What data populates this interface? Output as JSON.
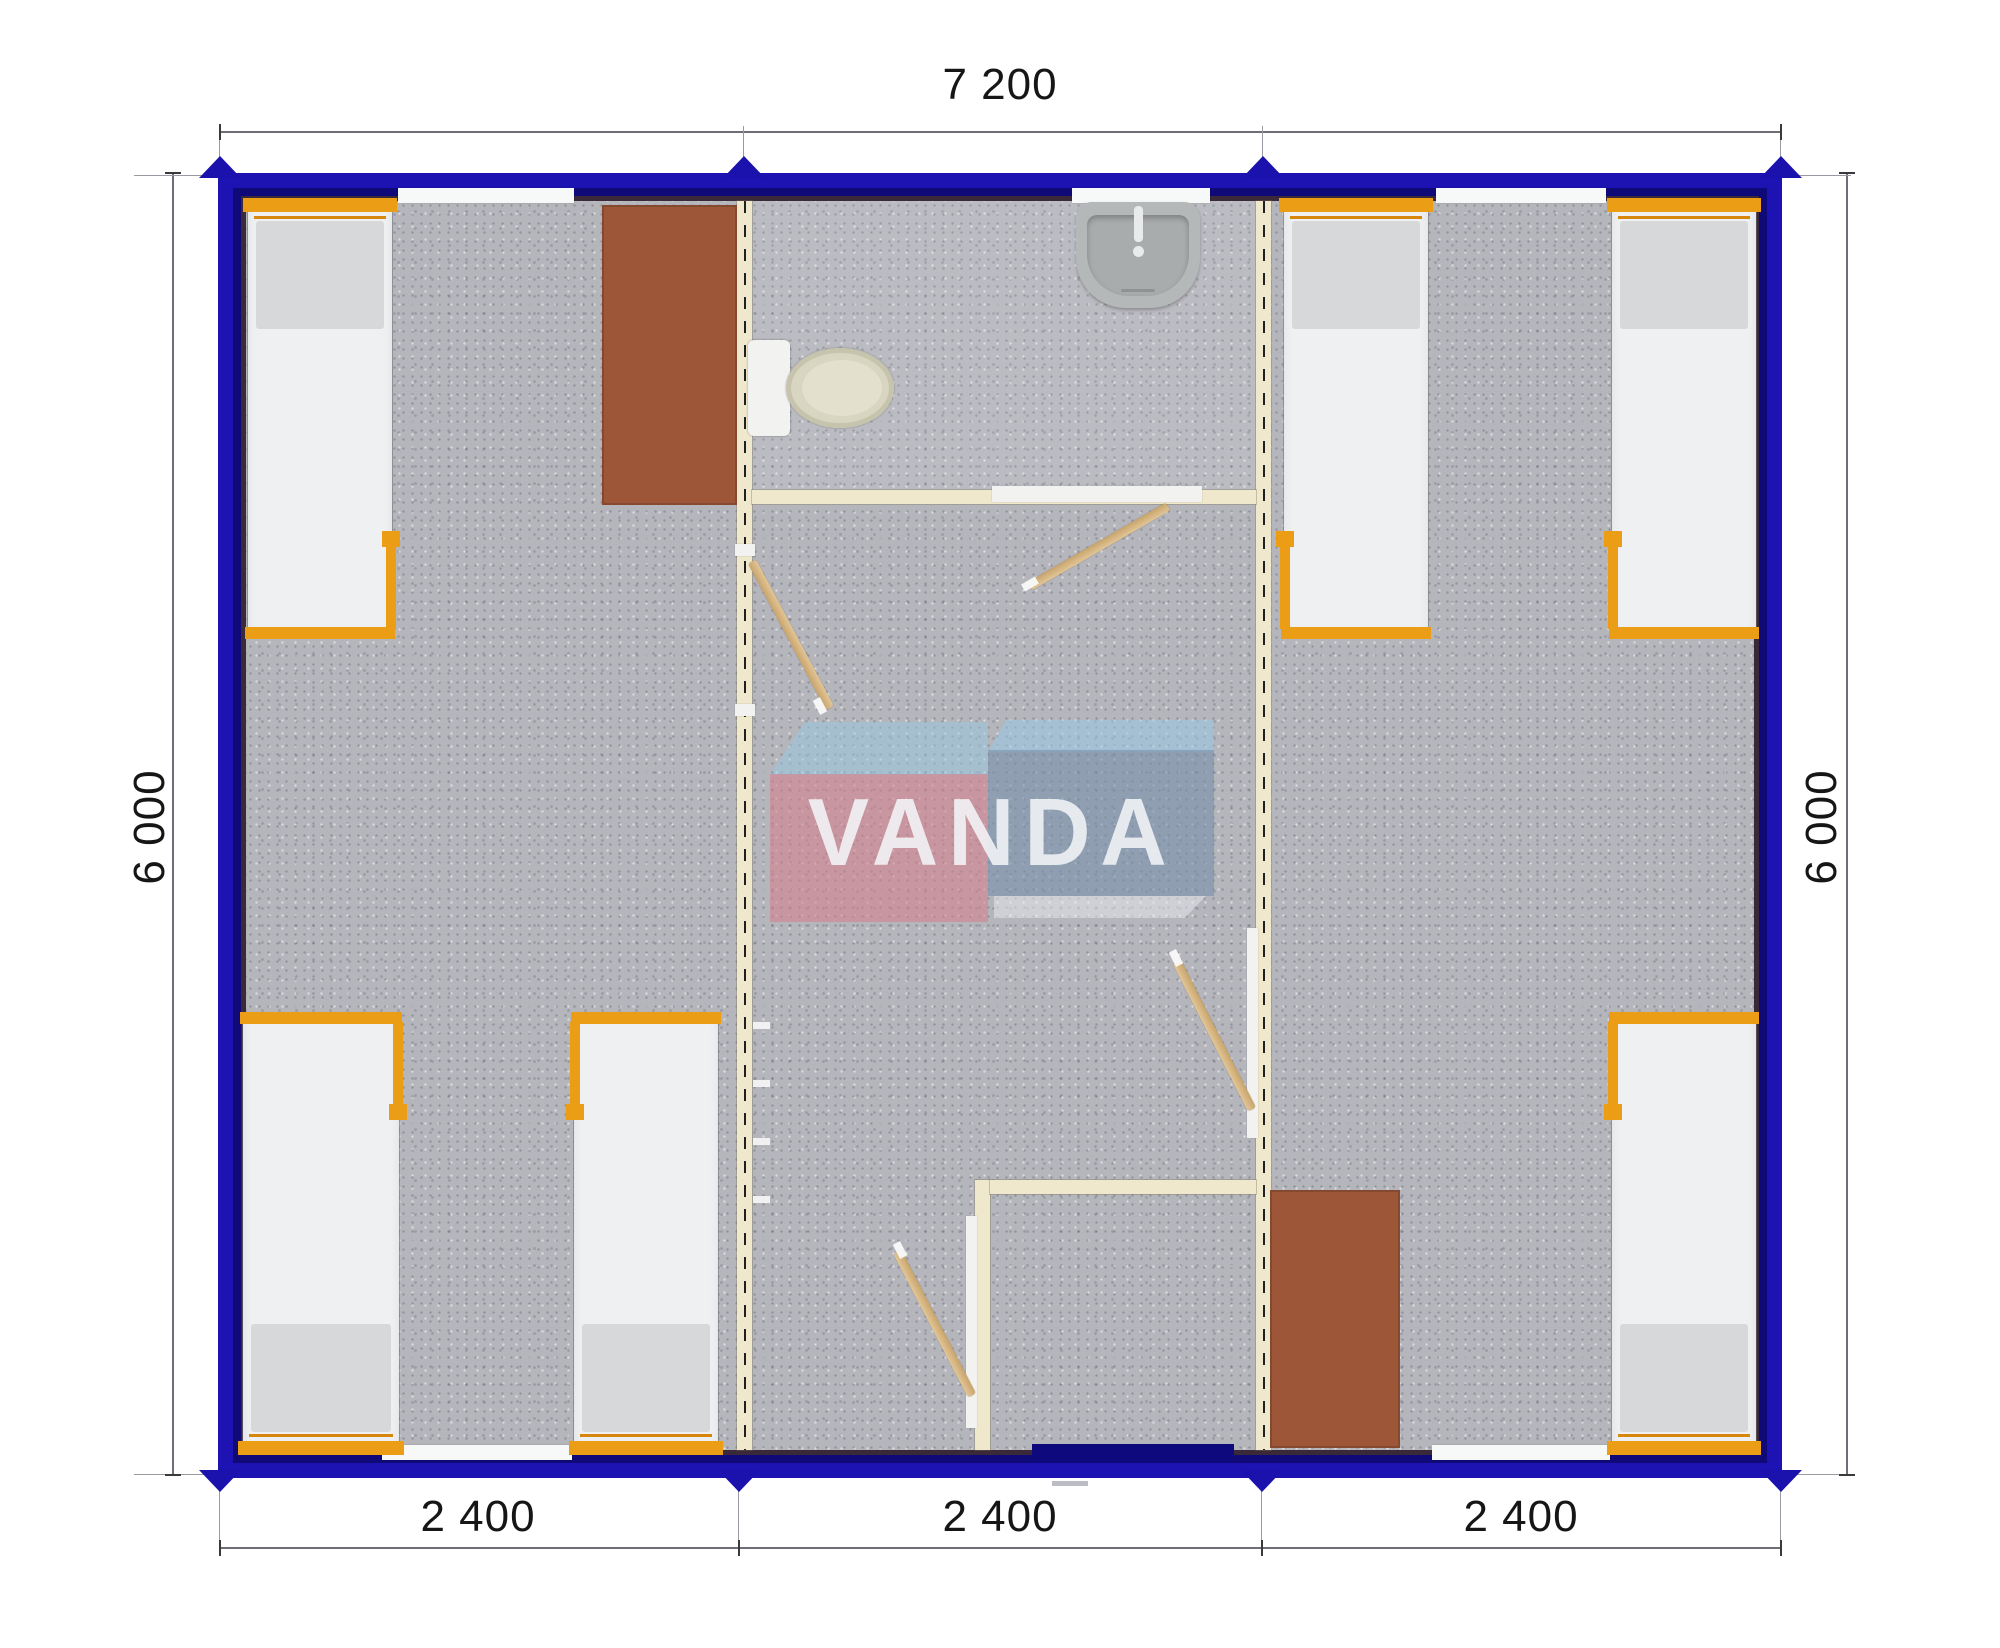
{
  "drawing": {
    "type": "modular-cabin-floor-plan-top-view",
    "logo_text": "VANDA",
    "dimensions": {
      "top": "7 200",
      "left": "6 000",
      "right": "6 000",
      "bottom": [
        "2 400",
        "2 400",
        "2 400"
      ]
    },
    "colors": {
      "frame_blue": "#1c13b2",
      "entry_door_navy": "#0e0a7e",
      "accent_orange": "#ea9d15",
      "wall_cream": "#efe8cd",
      "desk_brown": "#9d5738",
      "carpet_gray": "#b5b5bc",
      "door_wood": "#d2b183",
      "logo_pink": "#d8808d",
      "logo_blue": "#768faa",
      "logo_light_blue": "#96c9e2"
    },
    "rooms": {
      "left_module": "bedroom-3-beds-desk",
      "middle_module": "bathroom-hall-vestibule",
      "right_module": "bedroom-3-beds-desk"
    }
  }
}
